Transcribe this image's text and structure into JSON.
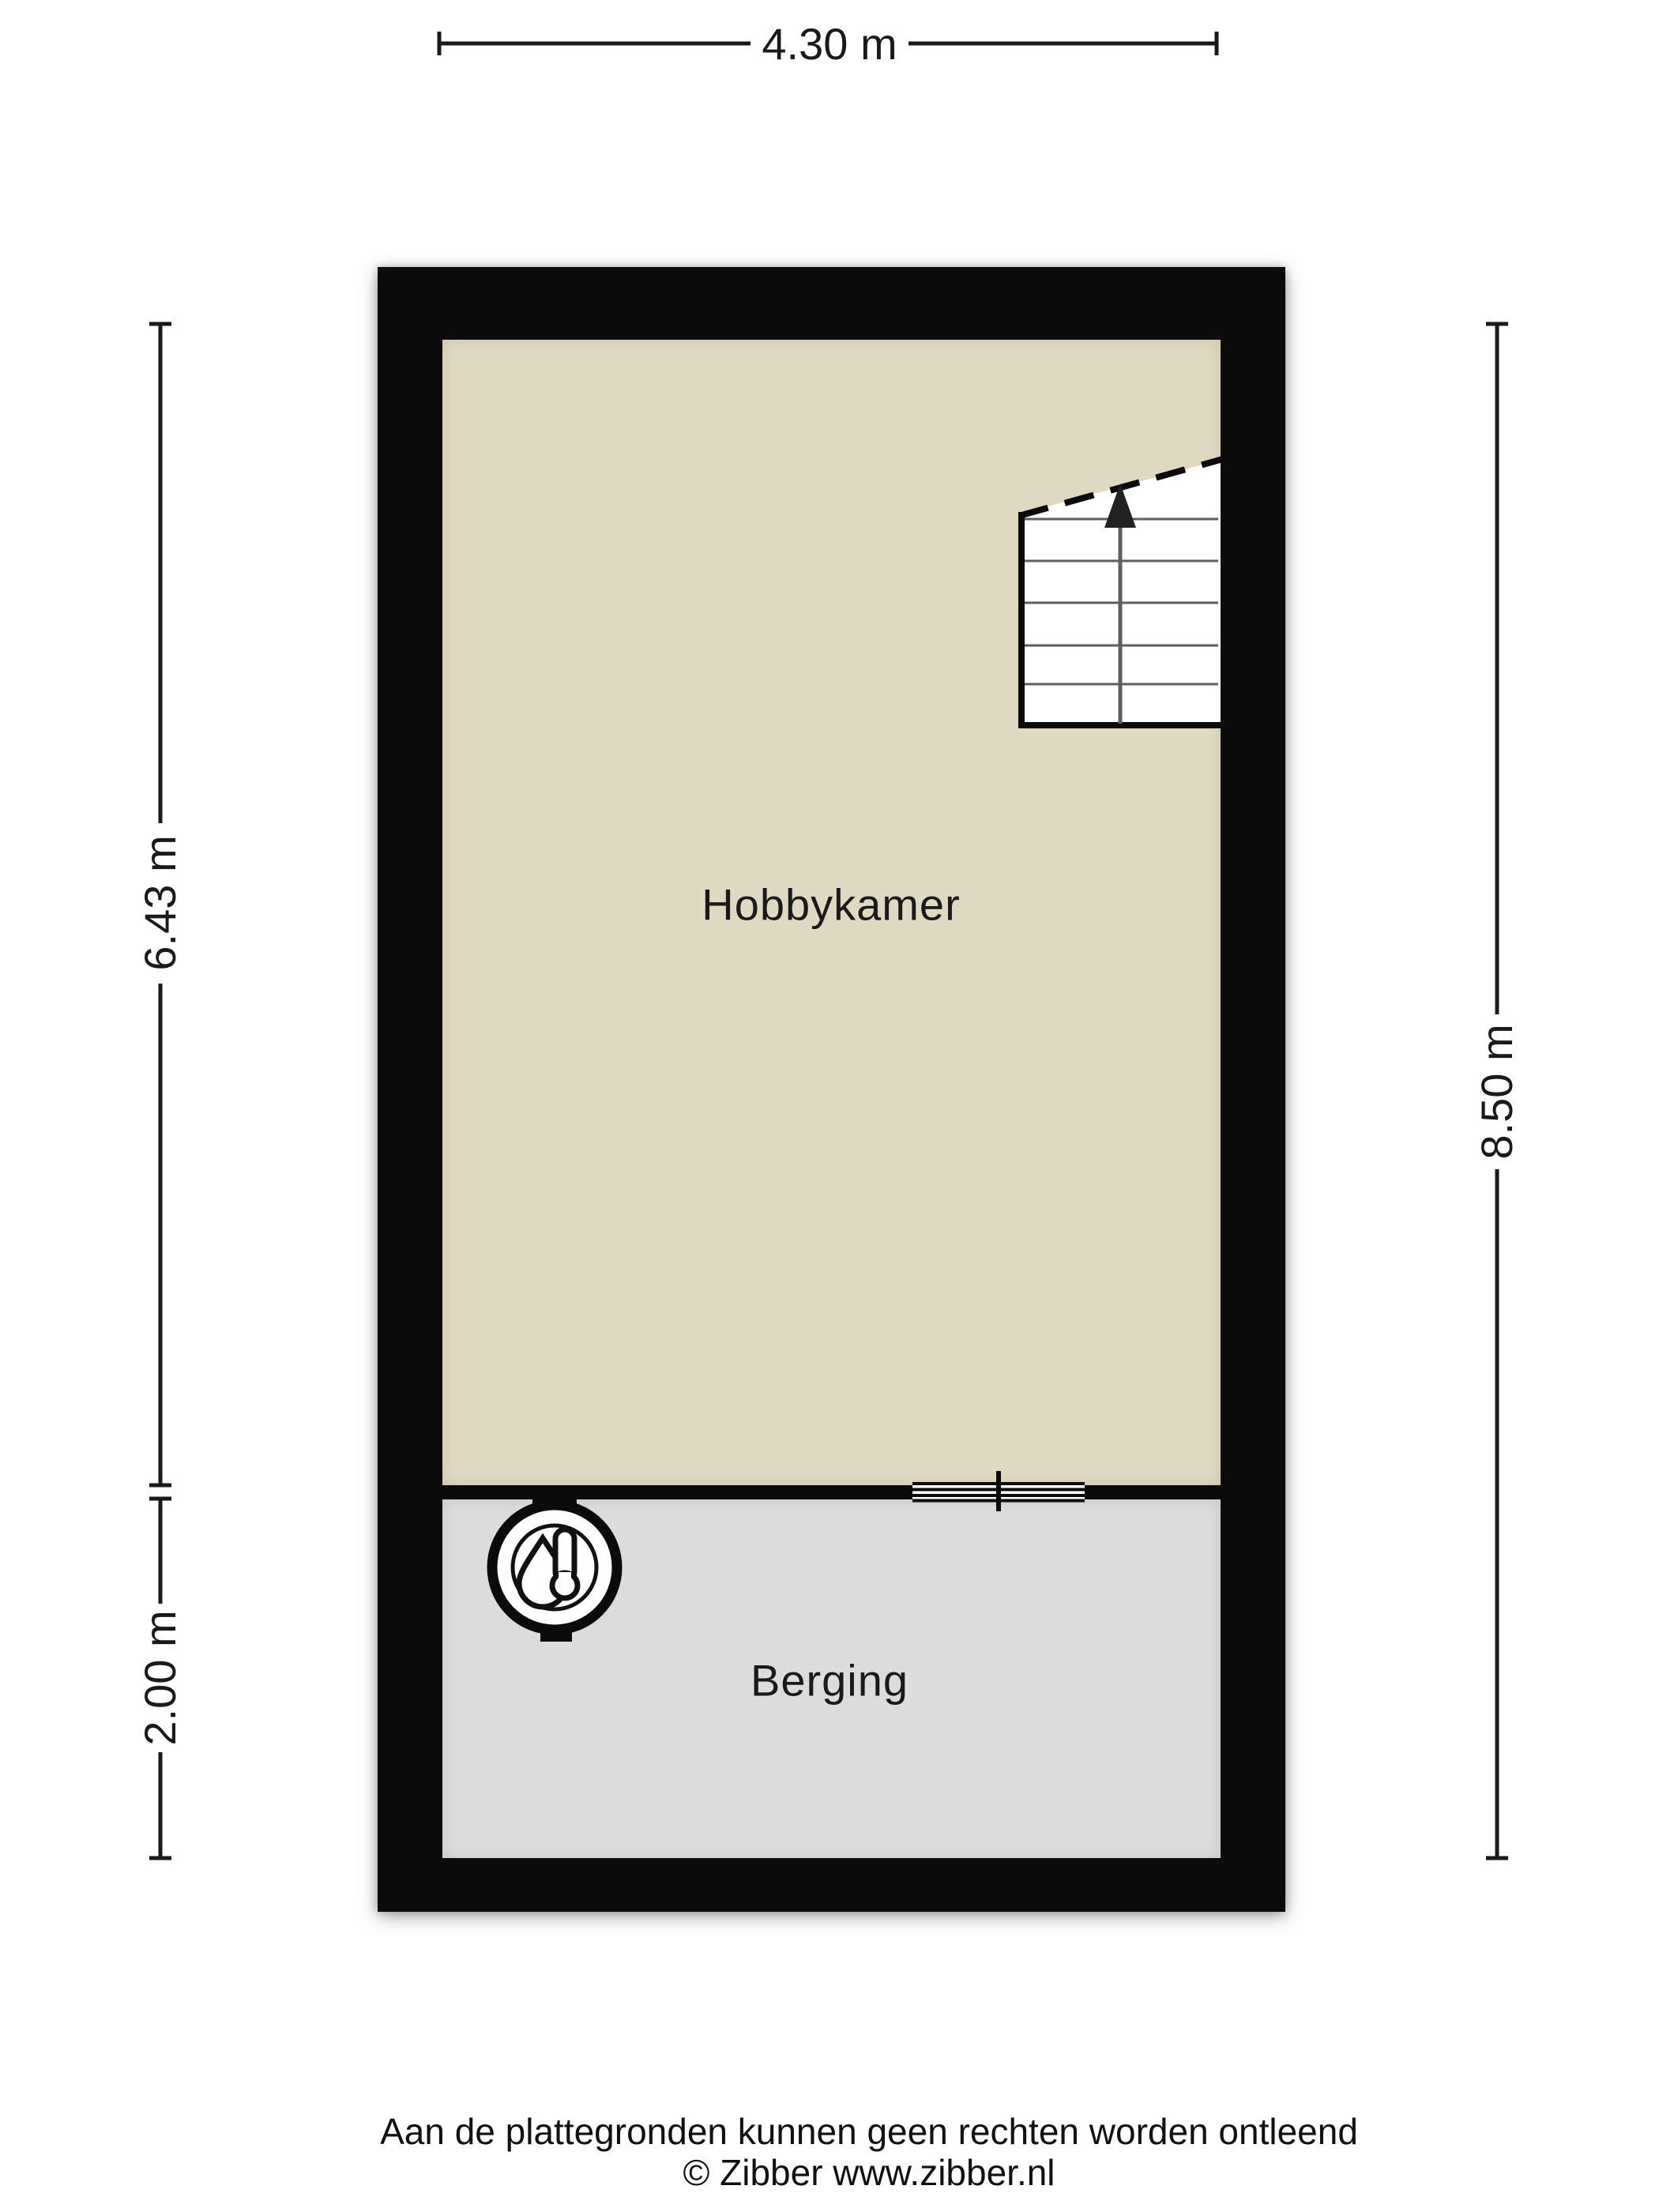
{
  "plan": {
    "rooms": [
      {
        "name": "hobbykamer",
        "label": "Hobbykamer"
      },
      {
        "name": "berging",
        "label": "Berging"
      }
    ],
    "features": {
      "stairs_icon": "staircase-with-up-arrow",
      "boiler_icon": "boiler-thermometer-droplet",
      "opening_icon": "window-sliding-door-symbol"
    }
  },
  "dimensions": {
    "width_top": "4.30 m",
    "hobbykamer_height": "6.43 m",
    "berging_height": "2.00 m",
    "total_height_right": "8.50 m"
  },
  "footer": {
    "disclaimer": "Aan de plattegronden kunnen geen rechten worden ontleend",
    "copyright": "© Zibber www.zibber.nl"
  },
  "colors": {
    "wall": "#0b0b0b",
    "floor-hobby": "#e0d9c1",
    "floor-berging": "#dcdcdc",
    "text": "#1a1a1a"
  }
}
